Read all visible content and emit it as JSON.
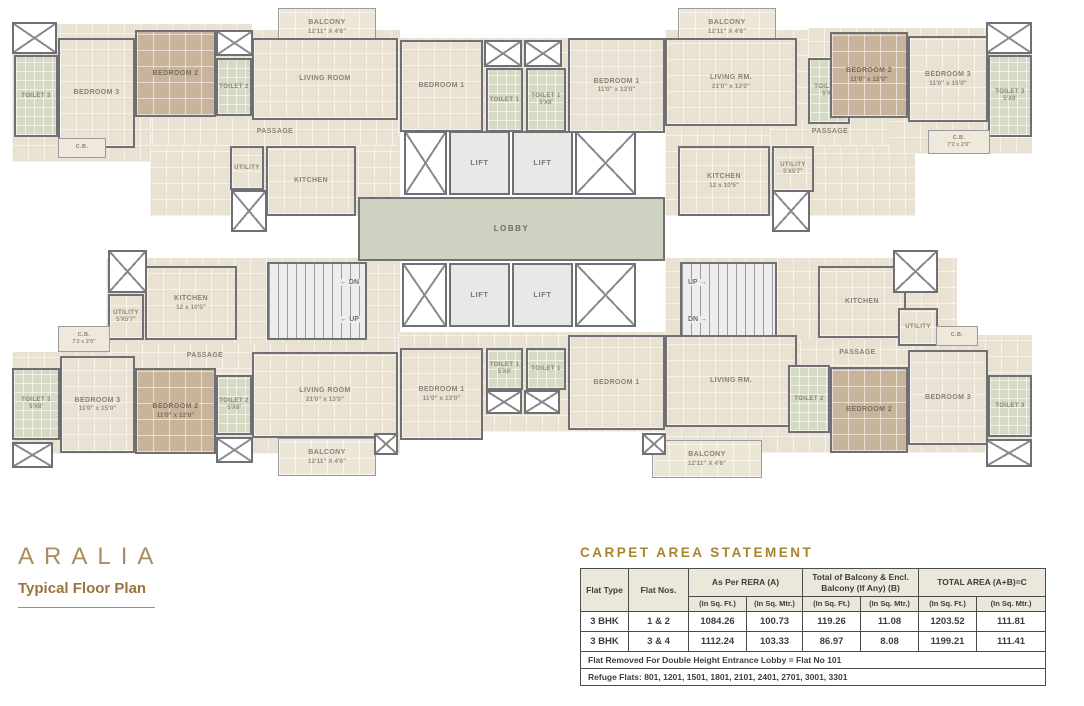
{
  "branding": {
    "logo": "ARALIA",
    "subtitle": "Typical Floor Plan"
  },
  "colors": {
    "accent_gold": "#A8842E",
    "logo_gold": "#A98C5F",
    "wall_grey": "#707074",
    "room_beige": "#E9E2D3",
    "bedroom_tan": "#C8B39B",
    "toilet_green": "#D6D9C4",
    "lobby_green": "#CED3C1",
    "stair_grey": "#EDEDED",
    "label_grey": "#8A8173",
    "table_border": "#4C4C4E"
  },
  "floorplan": {
    "elements": [
      {
        "name": "wing-slab-top-left-a",
        "kind": "slab",
        "x": 12,
        "y": 24,
        "w": 240,
        "h": 138
      },
      {
        "name": "wing-slab-top-left-b",
        "kind": "slab",
        "x": 150,
        "y": 30,
        "w": 250,
        "h": 186
      },
      {
        "name": "wing-slab-top-center",
        "kind": "slab",
        "x": 398,
        "y": 38,
        "w": 268,
        "h": 95
      },
      {
        "name": "wing-slab-top-right-a",
        "kind": "slab",
        "x": 665,
        "y": 30,
        "w": 250,
        "h": 186
      },
      {
        "name": "wing-slab-top-right-b",
        "kind": "slab",
        "x": 808,
        "y": 28,
        "w": 224,
        "h": 126
      },
      {
        "name": "wing-slab-bottom-left-a",
        "kind": "slab",
        "x": 106,
        "y": 258,
        "w": 294,
        "h": 112
      },
      {
        "name": "wing-slab-bottom-left-b",
        "kind": "slab",
        "x": 12,
        "y": 352,
        "w": 388,
        "h": 102
      },
      {
        "name": "wing-slab-bottom-center",
        "kind": "slab",
        "x": 398,
        "y": 332,
        "w": 268,
        "h": 100
      },
      {
        "name": "wing-slab-bottom-right-a",
        "kind": "slab",
        "x": 665,
        "y": 258,
        "w": 292,
        "h": 110
      },
      {
        "name": "wing-slab-bottom-right-b",
        "kind": "slab",
        "x": 665,
        "y": 335,
        "w": 367,
        "h": 118
      },
      {
        "name": "passage-top-left",
        "kind": "corridor",
        "label": "PASSAGE",
        "x": 152,
        "y": 118,
        "w": 246,
        "h": 28
      },
      {
        "name": "passage-top-right",
        "kind": "corridor",
        "label": "PASSAGE",
        "x": 770,
        "y": 118,
        "w": 120,
        "h": 28
      },
      {
        "name": "passage-bottom-left",
        "kind": "corridor",
        "label": "PASSAGE",
        "x": 110,
        "y": 343,
        "w": 190,
        "h": 26
      },
      {
        "name": "passage-bottom-right",
        "kind": "corridor",
        "label": "PASSAGE",
        "x": 800,
        "y": 340,
        "w": 115,
        "h": 26
      },
      {
        "name": "balcony-top-left",
        "kind": "balcony",
        "label": "BALCONY",
        "dims": "12'11\" X 4'6\"",
        "x": 278,
        "y": 8,
        "w": 98,
        "h": 38
      },
      {
        "name": "balcony-top-right",
        "kind": "balcony",
        "label": "BALCONY",
        "dims": "12'11\" X 4'6\"",
        "x": 678,
        "y": 8,
        "w": 98,
        "h": 38
      },
      {
        "name": "balcony-bottom-left",
        "kind": "balcony",
        "label": "BALCONY",
        "dims": "12'11\" X 4'6\"",
        "x": 278,
        "y": 438,
        "w": 98,
        "h": 38
      },
      {
        "name": "balcony-bottom-center",
        "kind": "balcony",
        "label": "BALCONY",
        "dims": "12'11\" X 4'6\"",
        "x": 652,
        "y": 440,
        "w": 110,
        "h": 38
      },
      {
        "name": "toilet-3-top-left",
        "kind": "toilet",
        "label": "TOILET 3",
        "x": 14,
        "y": 55,
        "w": 44,
        "h": 82
      },
      {
        "name": "bedroom-3-top-left",
        "kind": "room",
        "label": "BEDROOM 3",
        "x": 58,
        "y": 38,
        "w": 77,
        "h": 110
      },
      {
        "name": "bedroom-2-top-left",
        "kind": "bedroom",
        "label": "BEDROOM 2",
        "x": 135,
        "y": 30,
        "w": 81,
        "h": 87
      },
      {
        "name": "toilet-2-top-left",
        "kind": "toilet",
        "label": "TOILET 2",
        "x": 216,
        "y": 58,
        "w": 36,
        "h": 58
      },
      {
        "name": "living-room-top-left",
        "kind": "room",
        "label": "LIVING ROOM",
        "x": 252,
        "y": 38,
        "w": 146,
        "h": 82
      },
      {
        "name": "cb-top-left",
        "kind": "cb",
        "label": "C.B.",
        "x": 58,
        "y": 138,
        "w": 48,
        "h": 20
      },
      {
        "name": "utility-top-left",
        "kind": "utility",
        "label": "UTILITY",
        "x": 230,
        "y": 146,
        "w": 34,
        "h": 44
      },
      {
        "name": "kitchen-top-left",
        "kind": "kitchen",
        "label": "KITCHEN",
        "x": 266,
        "y": 146,
        "w": 90,
        "h": 70
      },
      {
        "name": "bedroom-1-top-left-wing",
        "kind": "room",
        "label": "BEDROOM 1",
        "x": 400,
        "y": 40,
        "w": 83,
        "h": 92
      },
      {
        "name": "toilet-1-top-a",
        "kind": "toilet",
        "label": "TOILET 1",
        "x": 486,
        "y": 68,
        "w": 37,
        "h": 64
      },
      {
        "name": "toilet-1-top-b",
        "kind": "toilet",
        "label": "TOILET 1",
        "dims": "5'X8'",
        "x": 526,
        "y": 68,
        "w": 40,
        "h": 64
      },
      {
        "name": "bedroom-1-top-right-wing",
        "kind": "room",
        "label": "BEDROOM 1",
        "dims": "11'0\" x 13'0\"",
        "x": 568,
        "y": 38,
        "w": 97,
        "h": 95
      },
      {
        "name": "living-rm-top-right",
        "kind": "room",
        "label": "LIVING RM.",
        "dims": "21'0\" x 13'0\"",
        "x": 665,
        "y": 38,
        "w": 132,
        "h": 88
      },
      {
        "name": "toilet-2-top-right",
        "kind": "toilet",
        "label": "TOILET 2",
        "dims": "5'X8'",
        "x": 808,
        "y": 58,
        "w": 42,
        "h": 66
      },
      {
        "name": "bedroom-2-top-right",
        "kind": "bedroom",
        "label": "BEDROOM 2",
        "dims": "11'0\" x 12'0\"",
        "x": 830,
        "y": 32,
        "w": 78,
        "h": 86
      },
      {
        "name": "bedroom-3-top-right",
        "kind": "room",
        "label": "BEDROOM 3",
        "dims": "11'0\" x 15'0\"",
        "x": 908,
        "y": 36,
        "w": 80,
        "h": 86
      },
      {
        "name": "toilet-3-top-right",
        "kind": "toilet",
        "label": "TOILET 3",
        "dims": "5'X8'",
        "x": 988,
        "y": 55,
        "w": 44,
        "h": 82
      },
      {
        "name": "cb-top-right",
        "kind": "cb",
        "label": "C.B.",
        "dims": "7'2 x 2'0\"",
        "x": 928,
        "y": 130,
        "w": 62,
        "h": 24
      },
      {
        "name": "utility-top-right",
        "kind": "utility",
        "label": "UTILITY",
        "dims": "5'X5'7\"",
        "x": 772,
        "y": 146,
        "w": 42,
        "h": 46
      },
      {
        "name": "kitchen-top-right",
        "kind": "kitchen",
        "label": "KITCHEN",
        "dims": "12 x 10'5\"",
        "x": 678,
        "y": 146,
        "w": 92,
        "h": 70
      },
      {
        "name": "lift-shaft-top-left",
        "kind": "shaft",
        "x": 404,
        "y": 131,
        "w": 43,
        "h": 64
      },
      {
        "name": "lift-top-1",
        "kind": "lift",
        "label": "LIFT",
        "x": 449,
        "y": 131,
        "w": 61,
        "h": 64
      },
      {
        "name": "lift-top-2",
        "kind": "lift",
        "label": "LIFT",
        "x": 512,
        "y": 131,
        "w": 61,
        "h": 64
      },
      {
        "name": "lift-shaft-top-right",
        "kind": "shaft",
        "x": 575,
        "y": 131,
        "w": 61,
        "h": 64
      },
      {
        "name": "lobby",
        "kind": "lobby",
        "label": "LOBBY",
        "x": 358,
        "y": 197,
        "w": 307,
        "h": 64
      },
      {
        "name": "lift-shaft-bottom-left",
        "kind": "shaft",
        "x": 402,
        "y": 263,
        "w": 45,
        "h": 64
      },
      {
        "name": "lift-bottom-1",
        "kind": "lift",
        "label": "LIFT",
        "x": 449,
        "y": 263,
        "w": 61,
        "h": 64
      },
      {
        "name": "lift-bottom-2",
        "kind": "lift",
        "label": "LIFT",
        "x": 512,
        "y": 263,
        "w": 61,
        "h": 64
      },
      {
        "name": "lift-shaft-bottom-right",
        "kind": "shaft",
        "x": 575,
        "y": 263,
        "w": 61,
        "h": 64
      },
      {
        "name": "staircase-left",
        "kind": "stair",
        "x": 267,
        "y": 262,
        "w": 100,
        "h": 78,
        "align": "right",
        "lines": [
          {
            "text": "DN",
            "arrow": "left"
          },
          {
            "text": "UP",
            "arrow": "left"
          }
        ]
      },
      {
        "name": "staircase-right",
        "kind": "stair",
        "x": 680,
        "y": 262,
        "w": 97,
        "h": 78,
        "align": "left",
        "lines": [
          {
            "text": "UP",
            "arrow": "right"
          },
          {
            "text": "DN",
            "arrow": "right"
          }
        ]
      },
      {
        "name": "kitchen-bottom-left",
        "kind": "kitchen",
        "label": "KITCHEN",
        "dims": "12 x 10'5\"",
        "x": 145,
        "y": 266,
        "w": 92,
        "h": 74
      },
      {
        "name": "utility-bottom-left",
        "kind": "utility",
        "label": "UTILITY",
        "dims": "5'X5'7\"",
        "x": 108,
        "y": 294,
        "w": 36,
        "h": 46
      },
      {
        "name": "cb-bottom-left",
        "kind": "cb",
        "label": "C.B.",
        "dims": "7'2 x 2'0\"",
        "x": 58,
        "y": 326,
        "w": 52,
        "h": 26
      },
      {
        "name": "toilet-3-bottom-left",
        "kind": "toilet",
        "label": "TOILET 3",
        "dims": "5'X8'",
        "x": 12,
        "y": 368,
        "w": 48,
        "h": 72
      },
      {
        "name": "bedroom-3-bottom-left",
        "kind": "room",
        "label": "BEDROOM 3",
        "dims": "11'0\" x 15'0\"",
        "x": 60,
        "y": 356,
        "w": 75,
        "h": 97
      },
      {
        "name": "bedroom-2-bottom-left",
        "kind": "bedroom",
        "label": "BEDROOM 2",
        "dims": "11'0\" x 12'0\"",
        "x": 135,
        "y": 368,
        "w": 81,
        "h": 86
      },
      {
        "name": "toilet-2-bottom-left",
        "kind": "toilet",
        "label": "TOILET 2",
        "dims": "5'X8'",
        "x": 216,
        "y": 375,
        "w": 36,
        "h": 60
      },
      {
        "name": "living-room-bottom-left",
        "kind": "room",
        "label": "LIVING ROOM",
        "dims": "21'0\" x 13'0\"",
        "x": 252,
        "y": 352,
        "w": 146,
        "h": 86
      },
      {
        "name": "bedroom-1-bottom-left-wing",
        "kind": "room",
        "label": "BEDROOM 1",
        "dims": "11'0\" x 13'0\"",
        "x": 400,
        "y": 348,
        "w": 83,
        "h": 92
      },
      {
        "name": "toilet-1-bottom-a",
        "kind": "toilet",
        "label": "TOILET 1",
        "dims": "5'X8'",
        "x": 486,
        "y": 348,
        "w": 37,
        "h": 42
      },
      {
        "name": "toilet-1-bottom-b",
        "kind": "toilet",
        "label": "TOILET 1",
        "x": 526,
        "y": 348,
        "w": 40,
        "h": 42
      },
      {
        "name": "bedroom-1-bottom-right-wing",
        "kind": "room",
        "label": "BEDROOM 1",
        "x": 568,
        "y": 335,
        "w": 97,
        "h": 95
      },
      {
        "name": "living-rm-bottom-right",
        "kind": "room",
        "label": "LIVING RM.",
        "x": 665,
        "y": 335,
        "w": 132,
        "h": 92
      },
      {
        "name": "kitchen-bottom-right",
        "kind": "kitchen",
        "label": "KITCHEN",
        "x": 818,
        "y": 266,
        "w": 88,
        "h": 72
      },
      {
        "name": "utility-bottom-right",
        "kind": "utility",
        "label": "UTILITY",
        "x": 898,
        "y": 308,
        "w": 40,
        "h": 38
      },
      {
        "name": "cb-bottom-right",
        "kind": "cb",
        "label": "C.B.",
        "x": 936,
        "y": 326,
        "w": 42,
        "h": 20
      },
      {
        "name": "toilet-2-bottom-right",
        "kind": "toilet",
        "label": "TOILET 2",
        "x": 788,
        "y": 365,
        "w": 42,
        "h": 68
      },
      {
        "name": "bedroom-2-bottom-right",
        "kind": "bedroom",
        "label": "BEDROOM 2",
        "x": 830,
        "y": 367,
        "w": 78,
        "h": 86
      },
      {
        "name": "bedroom-3-bottom-right",
        "kind": "room",
        "label": "BEDROOM 3",
        "x": 908,
        "y": 350,
        "w": 80,
        "h": 95
      },
      {
        "name": "toilet-3-bottom-right",
        "kind": "toilet",
        "label": "TOILET 3",
        "x": 988,
        "y": 375,
        "w": 44,
        "h": 62
      },
      {
        "name": "shaft-corner-top-left",
        "kind": "shaft",
        "x": 12,
        "y": 22,
        "w": 45,
        "h": 32
      },
      {
        "name": "shaft-top-left-1",
        "kind": "shaft",
        "x": 216,
        "y": 30,
        "w": 37,
        "h": 26
      },
      {
        "name": "shaft-top-center-1",
        "kind": "shaft",
        "x": 484,
        "y": 40,
        "w": 38,
        "h": 27
      },
      {
        "name": "shaft-top-center-2",
        "kind": "shaft",
        "x": 524,
        "y": 40,
        "w": 38,
        "h": 27
      },
      {
        "name": "shaft-corner-top-right",
        "kind": "shaft",
        "x": 986,
        "y": 22,
        "w": 46,
        "h": 32
      },
      {
        "name": "shaft-kitchen-top-left",
        "kind": "shaft",
        "x": 231,
        "y": 190,
        "w": 36,
        "h": 42
      },
      {
        "name": "shaft-kitchen-top-right",
        "kind": "shaft",
        "x": 772,
        "y": 190,
        "w": 38,
        "h": 42
      },
      {
        "name": "shaft-mid-left",
        "kind": "shaft",
        "x": 108,
        "y": 250,
        "w": 39,
        "h": 43
      },
      {
        "name": "shaft-mid-right",
        "kind": "shaft",
        "x": 893,
        "y": 250,
        "w": 45,
        "h": 43
      },
      {
        "name": "shaft-corner-bottom-left",
        "kind": "shaft",
        "x": 12,
        "y": 442,
        "w": 41,
        "h": 26
      },
      {
        "name": "shaft-bottom-left-1",
        "kind": "shaft",
        "x": 216,
        "y": 437,
        "w": 37,
        "h": 26
      },
      {
        "name": "shaft-corner-bottom-right",
        "kind": "shaft",
        "x": 986,
        "y": 439,
        "w": 46,
        "h": 28
      },
      {
        "name": "shaft-bottom-center-1",
        "kind": "shaft",
        "x": 486,
        "y": 390,
        "w": 36,
        "h": 24
      },
      {
        "name": "shaft-bottom-center-2",
        "kind": "shaft",
        "x": 524,
        "y": 390,
        "w": 36,
        "h": 24
      },
      {
        "name": "shaft-bottom-center-3",
        "kind": "shaft",
        "x": 374,
        "y": 433,
        "w": 24,
        "h": 22
      },
      {
        "name": "shaft-bottom-center-4",
        "kind": "shaft",
        "x": 642,
        "y": 433,
        "w": 24,
        "h": 22
      }
    ]
  },
  "table": {
    "title": "CARPET AREA STATEMENT",
    "header": {
      "flat_type": "Flat Type",
      "flat_nos": "Flat Nos.",
      "rera": "As Per RERA (A)",
      "balcony": "Total of Balcony & Encl. Balcony (If Any) (B)",
      "total": "TOTAL AREA (A+B)=C"
    },
    "subheaders": [
      "(In Sq. Ft.)",
      "(In Sq. Mtr.)",
      "(In Sq. Ft.)",
      "(In Sq. Mtr.)",
      "(In Sq. Ft.)",
      "(In Sq. Mtr.)"
    ],
    "rows": [
      [
        "3 BHK",
        "1 & 2",
        "1084.26",
        "100.73",
        "119.26",
        "11.08",
        "1203.52",
        "111.81"
      ],
      [
        "3 BHK",
        "3 & 4",
        "1112.24",
        "103.33",
        "86.97",
        "8.08",
        "1199.21",
        "111.41"
      ]
    ],
    "notes": [
      "Flat Removed For Double Height Entrance Lobby = Flat No 101",
      "Refuge Flats: 801, 1201, 1501, 1801, 2101, 2401, 2701, 3001, 3301"
    ]
  }
}
